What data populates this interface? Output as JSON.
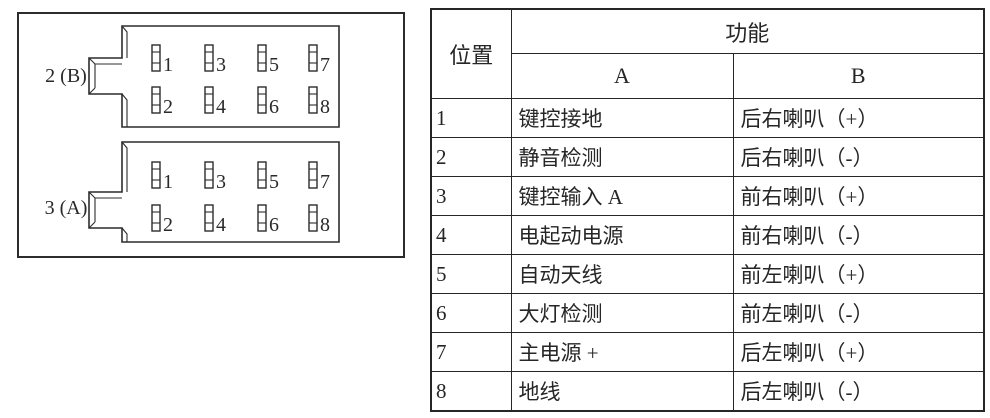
{
  "diagram": {
    "connectors": [
      {
        "label": "2 (B)",
        "pin_rows": [
          [
            "1",
            "3",
            "5",
            "7"
          ],
          [
            "2",
            "4",
            "6",
            "8"
          ]
        ]
      },
      {
        "label": "3 (A)",
        "pin_rows": [
          [
            "1",
            "3",
            "5",
            "7"
          ],
          [
            "2",
            "4",
            "6",
            "8"
          ]
        ]
      }
    ]
  },
  "table": {
    "headers": {
      "position": "位置",
      "function": "功能",
      "col_a": "A",
      "col_b": "B"
    },
    "rows": [
      {
        "pos": "1",
        "a": "键控接地",
        "b": "后右喇叭（+）"
      },
      {
        "pos": "2",
        "a": "静音检测",
        "b": "后右喇叭（-）"
      },
      {
        "pos": "3",
        "a": "键控输入 A",
        "b": "前右喇叭（+）"
      },
      {
        "pos": "4",
        "a": "电起动电源",
        "b": "前右喇叭（-）"
      },
      {
        "pos": "5",
        "a": "自动天线",
        "b": "前左喇叭（+）"
      },
      {
        "pos": "6",
        "a": "大灯检测",
        "b": "前左喇叭（-）"
      },
      {
        "pos": "7",
        "a": "主电源 +",
        "b": "后左喇叭（+）"
      },
      {
        "pos": "8",
        "a": "地线",
        "b": "后左喇叭（-）"
      }
    ]
  },
  "colors": {
    "line": "#2c2c2c",
    "text": "#262626",
    "background": "#ffffff"
  }
}
